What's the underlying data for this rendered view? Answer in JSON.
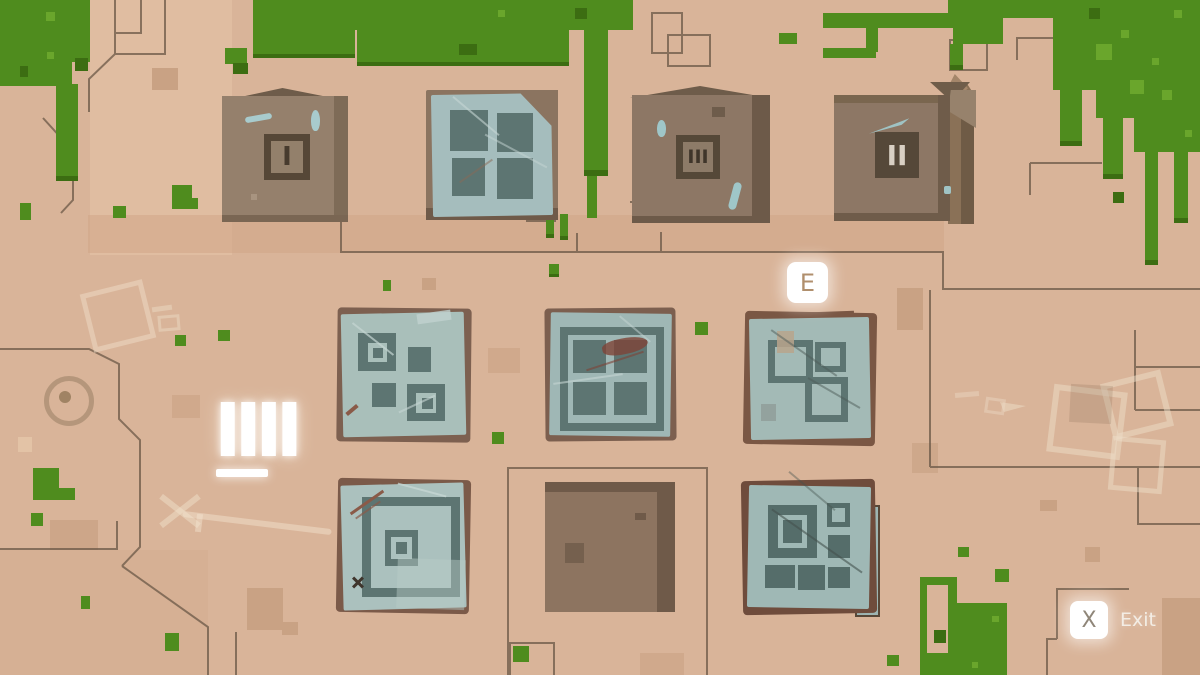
{
  "hud": {
    "interact_prompt": {
      "key_label": "E"
    },
    "exit_prompt": {
      "key_label": "X",
      "action_label": "Exit"
    },
    "tally_marks": "IIII"
  },
  "world": {
    "crates": {
      "crate_1_numeral": "I",
      "crate_2_numeral": "II",
      "crate_3_numeral": "III"
    }
  },
  "colors": {
    "sand": "#d9b499",
    "sand_dark_patch": "#c9a284",
    "grass": "#4f8c1e",
    "grass_light": "#6aa62c",
    "grass_dark": "#3c6d12",
    "tile_paper_blue": "#a7bebb",
    "tile_pattern_slate": "#5d7572",
    "crate_brown": "#8d7765",
    "frame_dark": "#554838",
    "outline_line": "#6b5847",
    "prompt_bg": "#ffffff",
    "prompt_key_text": "#b08f6d",
    "exit_text": "#f3ede5",
    "tally_white": "#ffffff"
  }
}
